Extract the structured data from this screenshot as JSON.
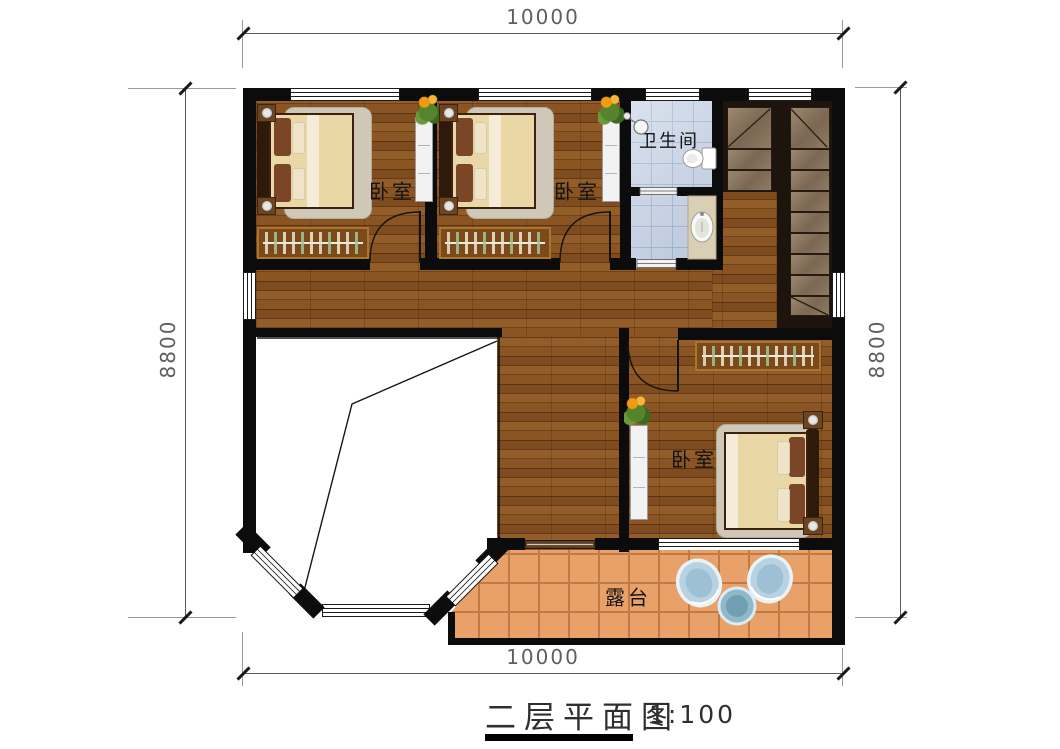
{
  "title": {
    "text": "二层平面图",
    "scale_label": "1:100"
  },
  "dimensions": {
    "top": "10000",
    "bottom": "10000",
    "left": "8800",
    "right": "8800"
  },
  "rooms": {
    "bedroom_top_left": {
      "label": "卧室"
    },
    "bedroom_top_middle": {
      "label": "卧室"
    },
    "bathroom": {
      "label": "卫生间"
    },
    "bedroom_right": {
      "label": "卧室"
    },
    "terrace": {
      "label": "露台"
    }
  },
  "colors": {
    "wall": "#0c0c0c",
    "wood_floor": "#7c4a1d",
    "bathroom_tile": "#c6d2e4",
    "terrace_tile": "#e8a169",
    "stair_tread": "#8d7866",
    "void_area": "#ffffff",
    "dimension_text": "#5f5f5f"
  }
}
